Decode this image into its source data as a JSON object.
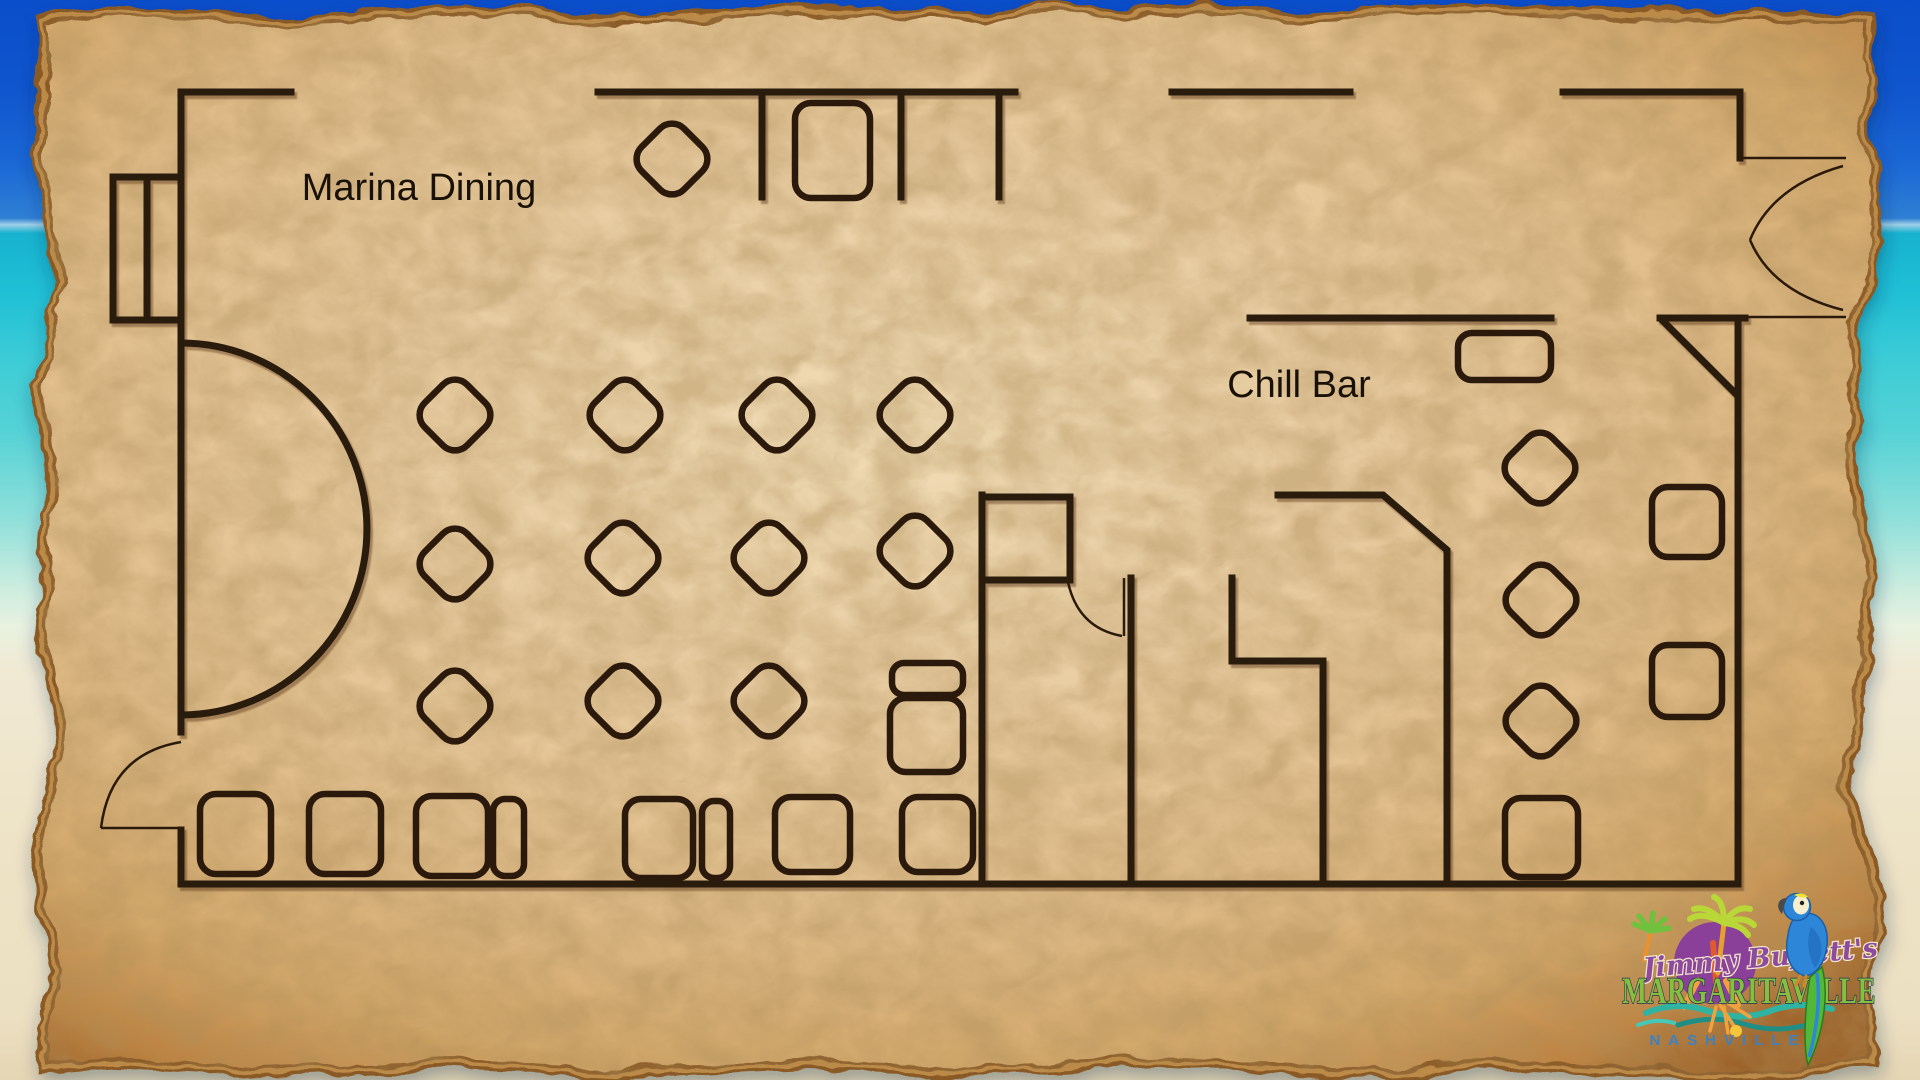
{
  "floor_plan": {
    "areas": [
      {
        "label": "Marina Dining",
        "diamond_tables": 12,
        "rect_tables": 11,
        "half_circle_booths": 1,
        "doors": 1
      },
      {
        "label": "Chill Bar",
        "diamond_tables": 3,
        "rect_tables": 4,
        "double_doors": 1
      }
    ]
  },
  "logo": {
    "script": "Jimmy Buffett's",
    "brand": "MARGARITAVILLE",
    "city": "NASHVILLE"
  },
  "colors": {
    "wall": "#2b1a0c",
    "ink": "#1a1106",
    "parchment": "#e9cda2",
    "parchment_edge": "#9c6830",
    "sky": "#0f55cd",
    "ocean": "#1fc0d6",
    "sand": "#eee3c6",
    "brand_green": "#85bf3d",
    "brand_outline": "#233357",
    "script_purple": "#8d4b9e",
    "city_blue": "#3b82c4",
    "sun_purple": "#8a4099",
    "ray_orange": "#f2a23c",
    "splash_yellow": "#f5c53a",
    "palm_green": "#6fc13e",
    "palm_yellow": "#b9d838",
    "wave_teal": "#2fb4a4",
    "wave_deep": "#1f8f86",
    "parrot_blue": "#2e86d9",
    "parrot_wing": "#2573c4",
    "parrot_face": "#f5efce",
    "parrot_tail_green": "#52b838",
    "trunk_orange": "#e8912d"
  }
}
